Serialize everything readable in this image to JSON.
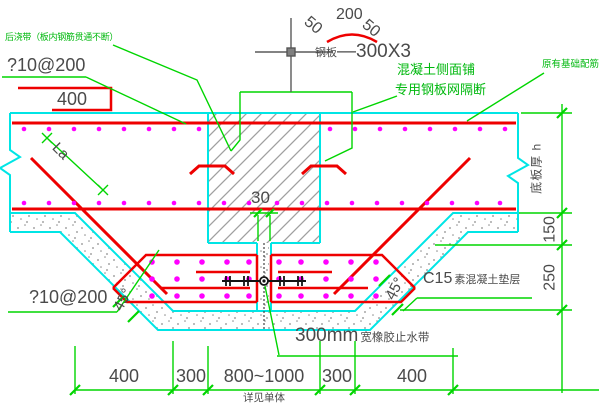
{
  "drawing": {
    "labels": {
      "note_top": "后浇带（板内钢筋贯通不断）",
      "rebar_top": "?10@200",
      "box_dim": "400",
      "dim50_left": "50",
      "dim200": "200",
      "dim50_right": "50",
      "plate_prefix": "钢板",
      "plate_size": "—300X3",
      "side_note_1": "混凝土侧面铺",
      "side_note_2": "专用钢板网隔断",
      "existing_rebar": "原有基础配筋",
      "la": "La",
      "dim30": "30",
      "slab_thickness": "底板厚 h",
      "dim150": "150",
      "dim250": "250",
      "angle_left": "45°",
      "angle_right": "45°",
      "c15_num": "C15",
      "c15_txt": "素混凝土垫层",
      "rebar_bottom": "?10@200",
      "waterstop_num": "300mm",
      "waterstop_txt": "宽橡胶止水带",
      "dims_bottom": [
        "400",
        "300",
        "800~1000",
        "300",
        "400"
      ],
      "see_note": "详见单体"
    },
    "colors": {
      "outline_cyan": "#00e5e5",
      "rebar_red": "#ee0000",
      "annotation_green": "#00d500",
      "dot_magenta": "#ff00ff",
      "text_gray": "#4a4a4a",
      "hatch_gray": "#a0a0a0"
    }
  }
}
